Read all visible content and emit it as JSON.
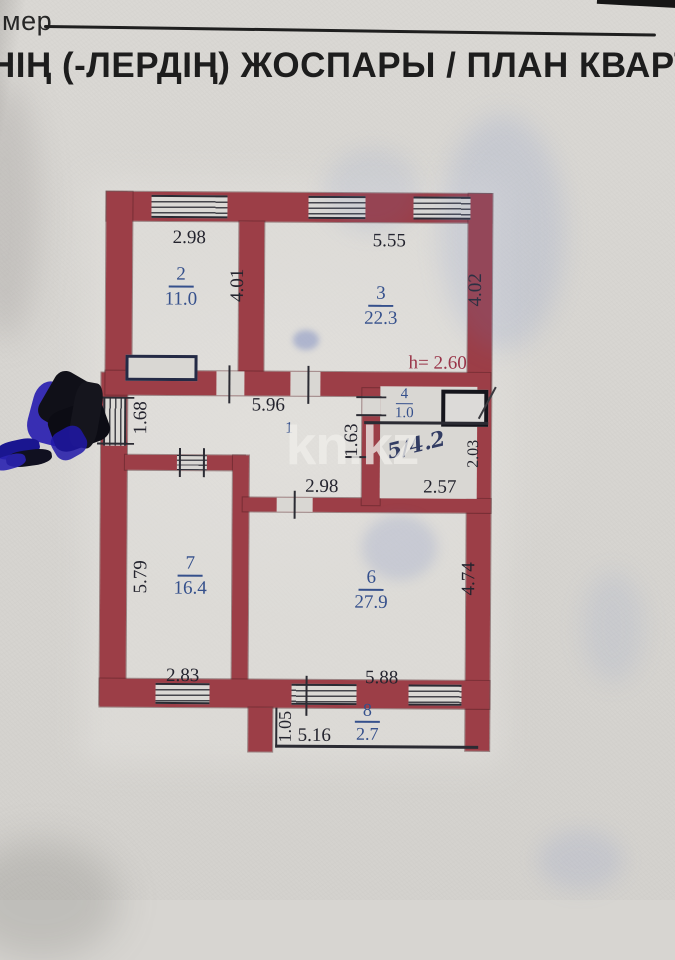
{
  "page": {
    "corner_label": "мер",
    "title": "НІҢ (-ЛЕРДІҢ) ЖОСПАРЫ / ПЛАН КВАРТИ",
    "watermark": "kn.kz"
  },
  "plan": {
    "height_note": "h= 2.60",
    "rooms": {
      "r1": {
        "number": "1"
      },
      "r2": {
        "number": "2",
        "area": "11.0"
      },
      "r3": {
        "number": "3",
        "area": "22.3"
      },
      "r4": {
        "number": "4",
        "area": "1.0"
      },
      "r5": {
        "handwritten": "5/4.2"
      },
      "r6": {
        "number": "6",
        "area": "27.9"
      },
      "r7": {
        "number": "7",
        "area": "16.4"
      },
      "r8": {
        "number": "8",
        "area": "2.7"
      }
    },
    "dims": {
      "top_room2": "2.98",
      "top_room3": "5.55",
      "side_room2": "4.01",
      "side_room3": "4.02",
      "hall_width": "5.96",
      "left_window": "1.68",
      "wc_side": "1.63",
      "room6_top": "2.98",
      "bath_width": "2.57",
      "bath_side": "2.03",
      "room7_side": "5.79",
      "room7_bottom": "2.83",
      "room6_bottom": "5.88",
      "room6_side": "4.74",
      "balcony_side": "1.05",
      "balcony_bottom": "5.16"
    }
  },
  "colors": {
    "wall": "#9c3e47",
    "paper": "#d7d5d1",
    "dimension_text": "#24242e",
    "room_label": "#35508c",
    "height_note": "#993448"
  }
}
